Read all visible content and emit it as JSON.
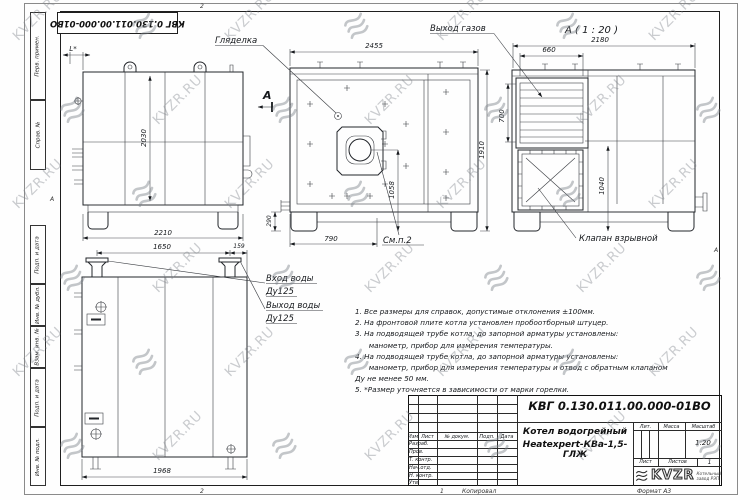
{
  "watermark": {
    "text": "KVZR.RU"
  },
  "stamp_top": "КВГ 0.130.011.00.000-01ВО",
  "margins": {
    "left_labels": [
      "Перв. примен.",
      "Справ. №",
      "Подп. и дата",
      "Инв. № дубл.",
      "Взам. инв. №",
      "Подп. и дата",
      "Инв. № подл."
    ],
    "zone_top": "2",
    "zone_bottom": "2",
    "sheet_zone": "1",
    "zone_left": "А",
    "zone_right": "А",
    "copied_label": "Копировал",
    "format_label": "Формат А3"
  },
  "views": {
    "side": {
      "dim_l": "L*",
      "dim_height": "2030",
      "dim_width": "2210",
      "section_label": "А"
    },
    "front": {
      "label_sight": "Гляделка",
      "dim_top": "2455",
      "dim_right": "1910",
      "dim_burner": "1058",
      "dim_bottom": "790",
      "dim_foot": "290",
      "note_ref": "См.п.2"
    },
    "detail": {
      "title": "А ( 1 : 20 )",
      "label_gas": "Выход газов",
      "dim_width": "2180",
      "dim_grille_w": "660",
      "dim_grille_h": "700",
      "dim_valve_h": "1040",
      "label_valve": "Клапан взрывной"
    },
    "top": {
      "dim_pipes": "1650",
      "dim_edge": "159",
      "dim_width": "1968",
      "label_in1": "Вход воды",
      "label_in2": "Ду125",
      "label_out1": "Выход воды",
      "label_out2": "Ду125"
    }
  },
  "notes": [
    "1. Все размеры для справок, допустимые отклонения ±100мм.",
    "2. На фронтовой плите котла установлен пробоотборный штуцер.",
    "3. На подводящей трубе котла, до запорной арматуры установлены:",
    "      манометр, прибор для измерения температуры.",
    "4. На подводящей трубе котла, до запорной арматуры установлены:",
    "      манометр, прибор для измерения температуры и отвод с обратным клапаном",
    "Ду не менее 50 мм.",
    "5. *Размер уточняется в зависимости от марки горелки."
  ],
  "title_block": {
    "doc_number": "КВГ 0.130.011.00.000-01ВО",
    "title_line1": "Котел водогрейный",
    "title_line2": "Heatexpert-КВа-1,5-ГЛЖ",
    "col_izm": "Изм.",
    "col_list": "Лист",
    "col_doc": "№ докум.",
    "col_sign": "Подп.",
    "col_date": "Дата",
    "row_labels": [
      "Разраб.",
      "Пров.",
      "Т. контр.",
      "Нач.отд.",
      "Н. контр.",
      "Утв."
    ],
    "lit_label": "Лит.",
    "mass_label": "Масса",
    "scale_label": "Масштаб",
    "scale_value": "1:20",
    "sheet_label": "Лист",
    "sheets_label": "Листов",
    "sheets_value": "1",
    "logo_text": "KVZR",
    "logo_sub1": "Котельный",
    "logo_sub2": "завод РЭП"
  }
}
